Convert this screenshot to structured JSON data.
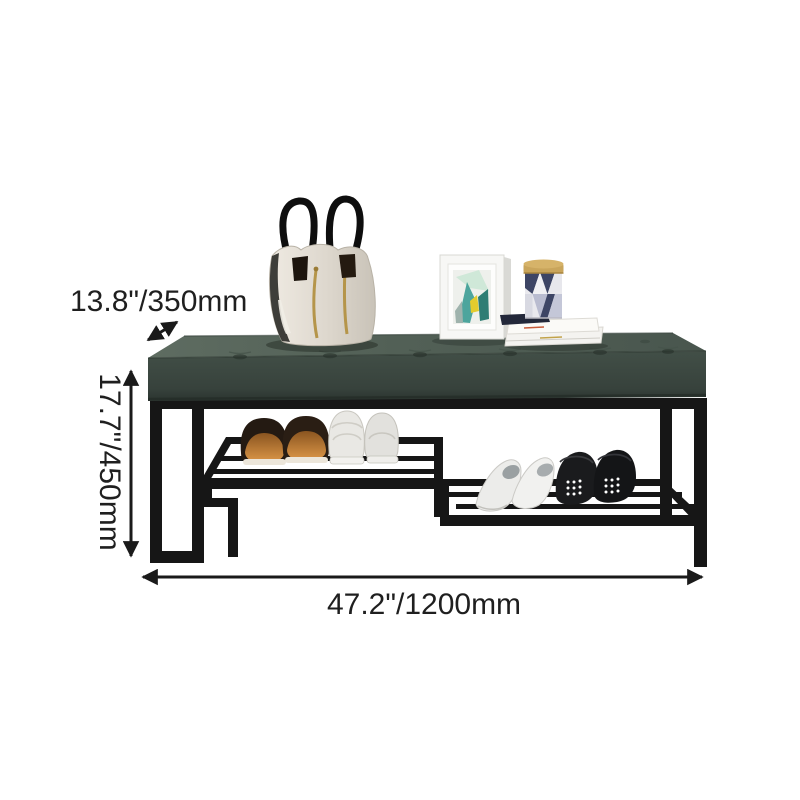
{
  "page": {
    "background_color": "#ffffff",
    "description": "Product dimension diagram of a metal shoe-rack bench with a dark green tufted seat"
  },
  "annotations": {
    "depth": {
      "label": "13.8\"/350mm",
      "arrow": "diagonal-double-arrow"
    },
    "height": {
      "label": "17.7\"/450mm",
      "arrow": "vertical-double-arrow"
    },
    "width": {
      "label": "47.2\"/1200mm",
      "arrow": "horizontal-double-arrow"
    }
  },
  "scene": {
    "furniture": "shoe storage bench",
    "seat": "dark green tufted upholstered cushion",
    "frame": "black metal base with two staggered slatted shoe shelves",
    "props_on_seat": [
      "ivory handbag with black handles and gold zippers",
      "white photo frame with abstract art",
      "triangle-patterned canister with brass lid",
      "stacked white books"
    ],
    "shoes_on_shelves": [
      "brown slippers",
      "white sneakers",
      "white slip-ons",
      "black perforated loafers"
    ]
  },
  "colors": {
    "annotation_text": "#1f1f1f",
    "arrow": "#1a1a1a",
    "metal_frame": "#161616",
    "seat_top": "#57665c",
    "seat_front": "#3c4842",
    "bag_body": "#e0dbd2",
    "zipper_gold": "#b5954a",
    "slipper_inner": "#c07a30",
    "sneaker_white": "#e9e8e4",
    "black_shoe": "#1a1b1d",
    "canister_navy": "#3d4565",
    "canister_lid": "#c9a55b",
    "art_teal": "#3f9e96",
    "art_yellow": "#e3cc2e"
  }
}
